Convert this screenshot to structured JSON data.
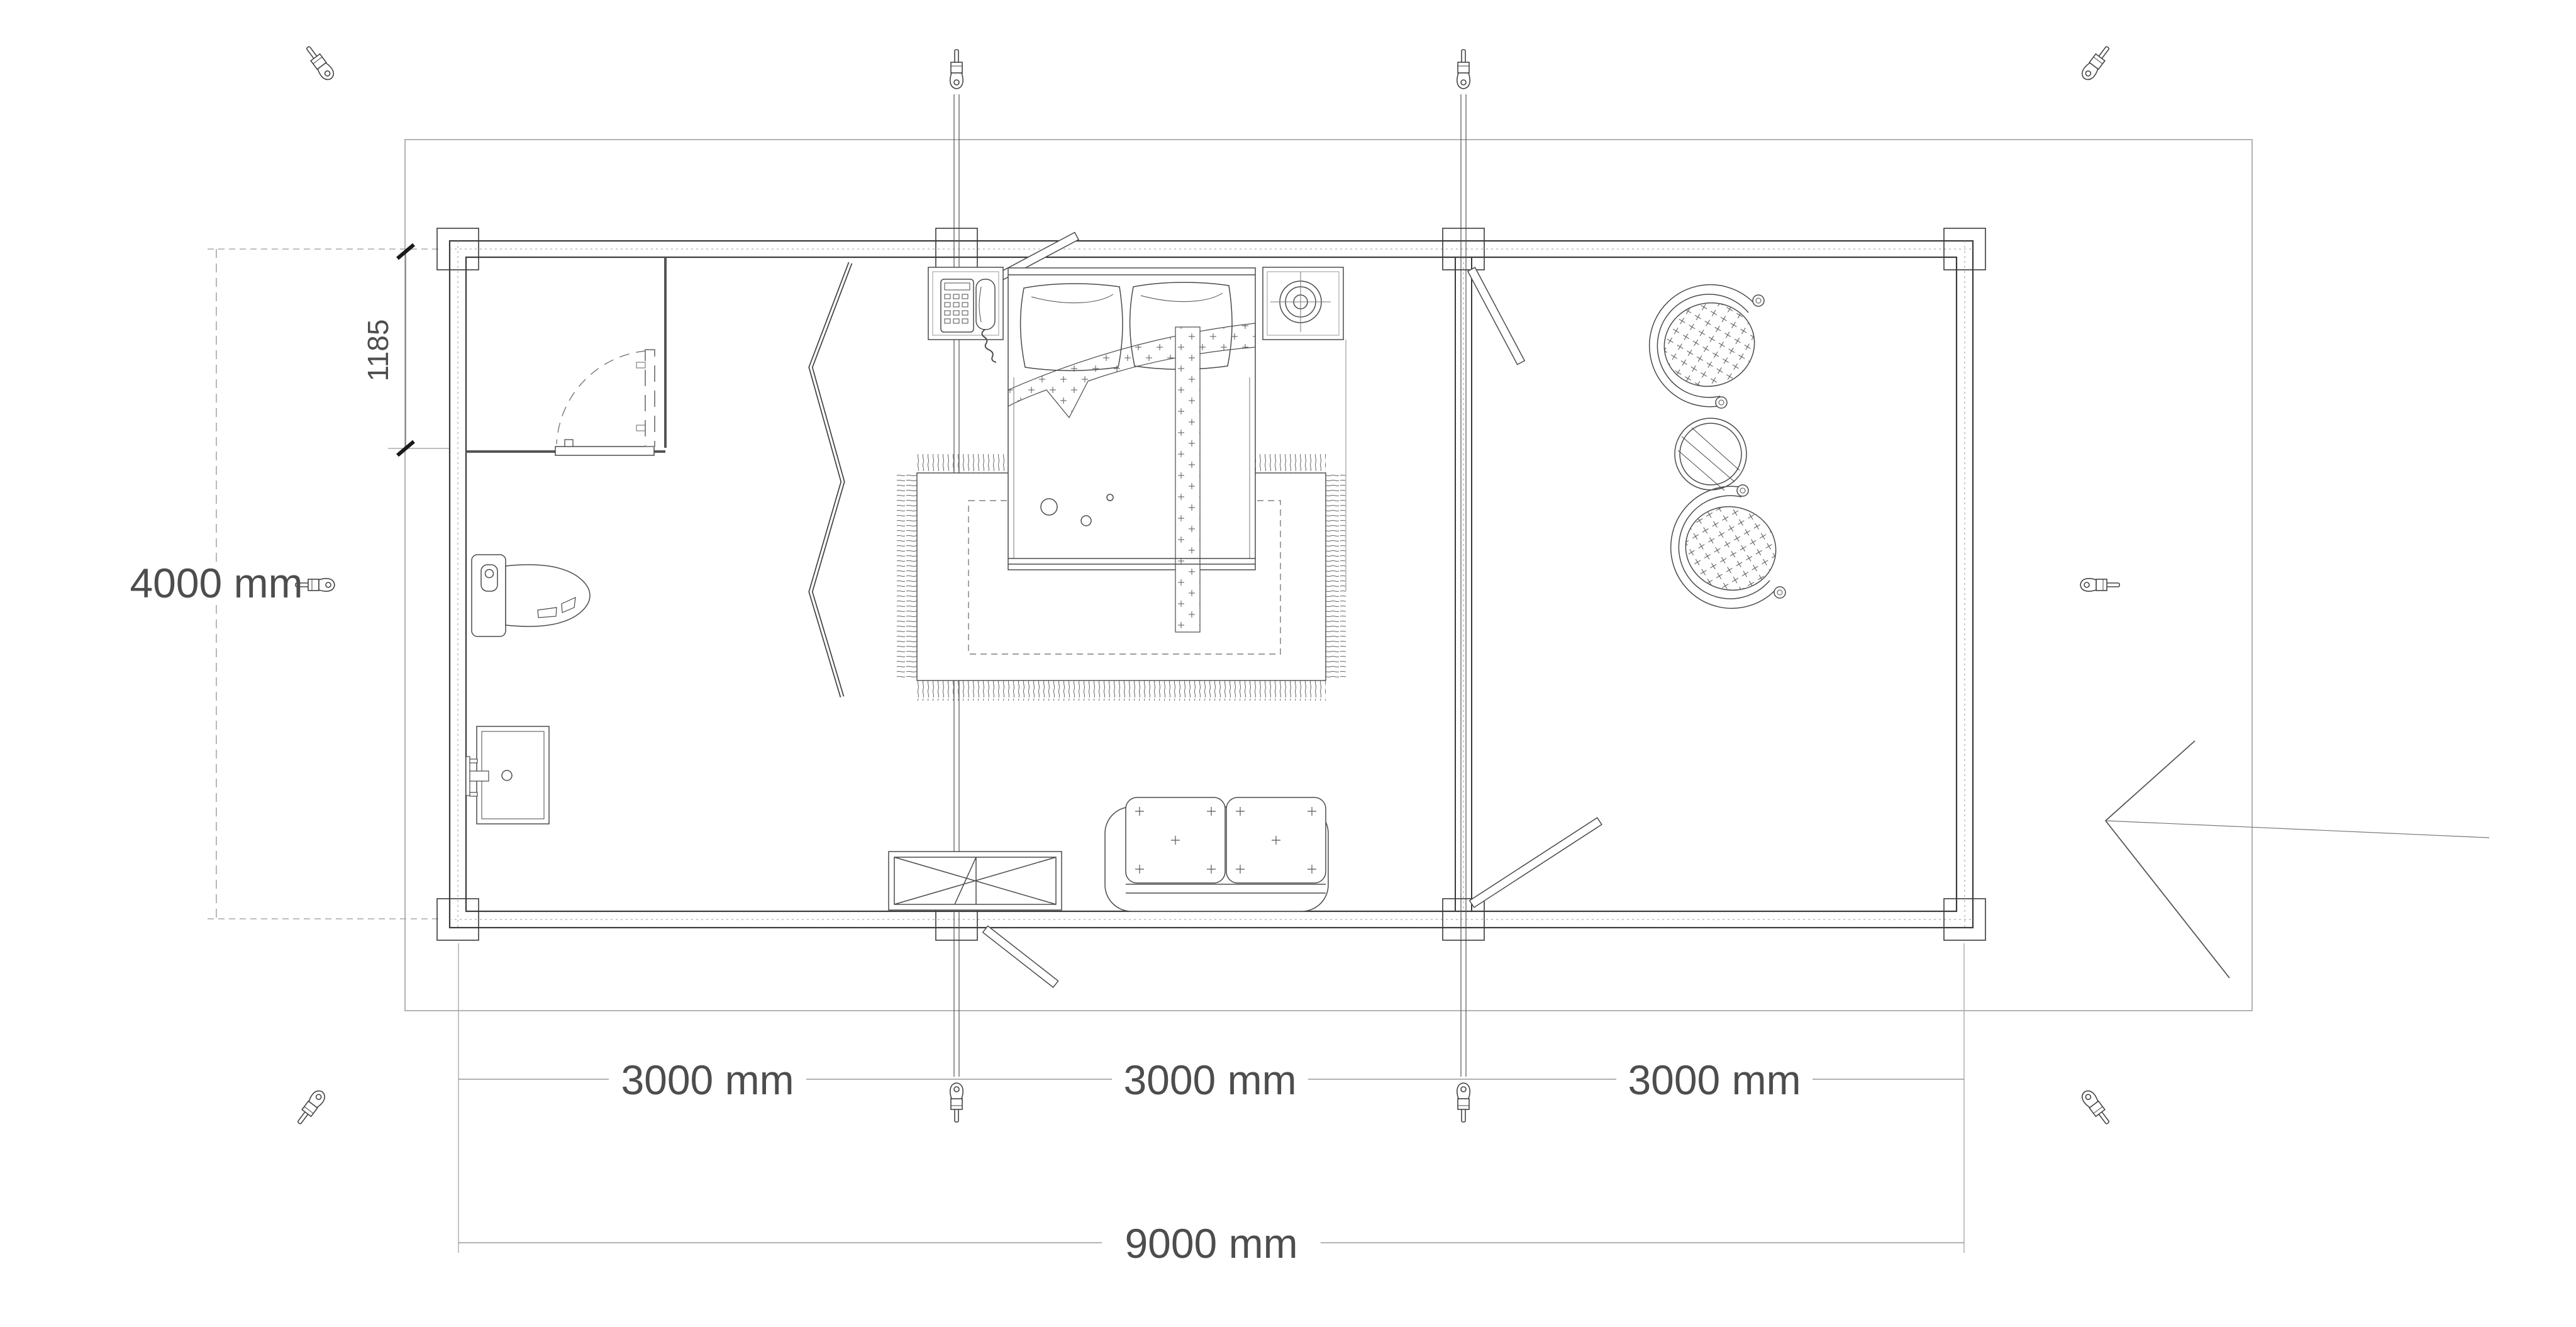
{
  "sheet": {
    "background": "#ffffff",
    "wall_line_color": "#3a3a3a",
    "furniture_line_color": "#4a4a4a",
    "dimension_text_color": "#4d4d4d",
    "dimension_line_color": "#999999",
    "boundary_color": "#b3b3b3"
  },
  "dimensions": {
    "total_width": "9000 mm",
    "total_height": "4000 mm",
    "segment_1": "3000 mm",
    "segment_2": "3000 mm",
    "segment_3": "3000 mm",
    "bathroom_offset": "1185"
  },
  "furniture_icons": [
    "double-bed-icon",
    "pillow-icon",
    "blanket-fold-icon",
    "area-rug-icon",
    "nightstand-telephone-icon",
    "nightstand-lamp-icon",
    "folding-screen-icon",
    "toilet-icon",
    "sink-vanity-icon",
    "storage-box-icon",
    "loveseat-sofa-icon",
    "papasan-chair-icon",
    "round-table-icon"
  ],
  "annotation_icons": [
    "turnbuckle-screw-icon",
    "storm-brace-rod-icon",
    "corner-post-icon",
    "door-swing-icon",
    "entrance-arrow-icon"
  ]
}
